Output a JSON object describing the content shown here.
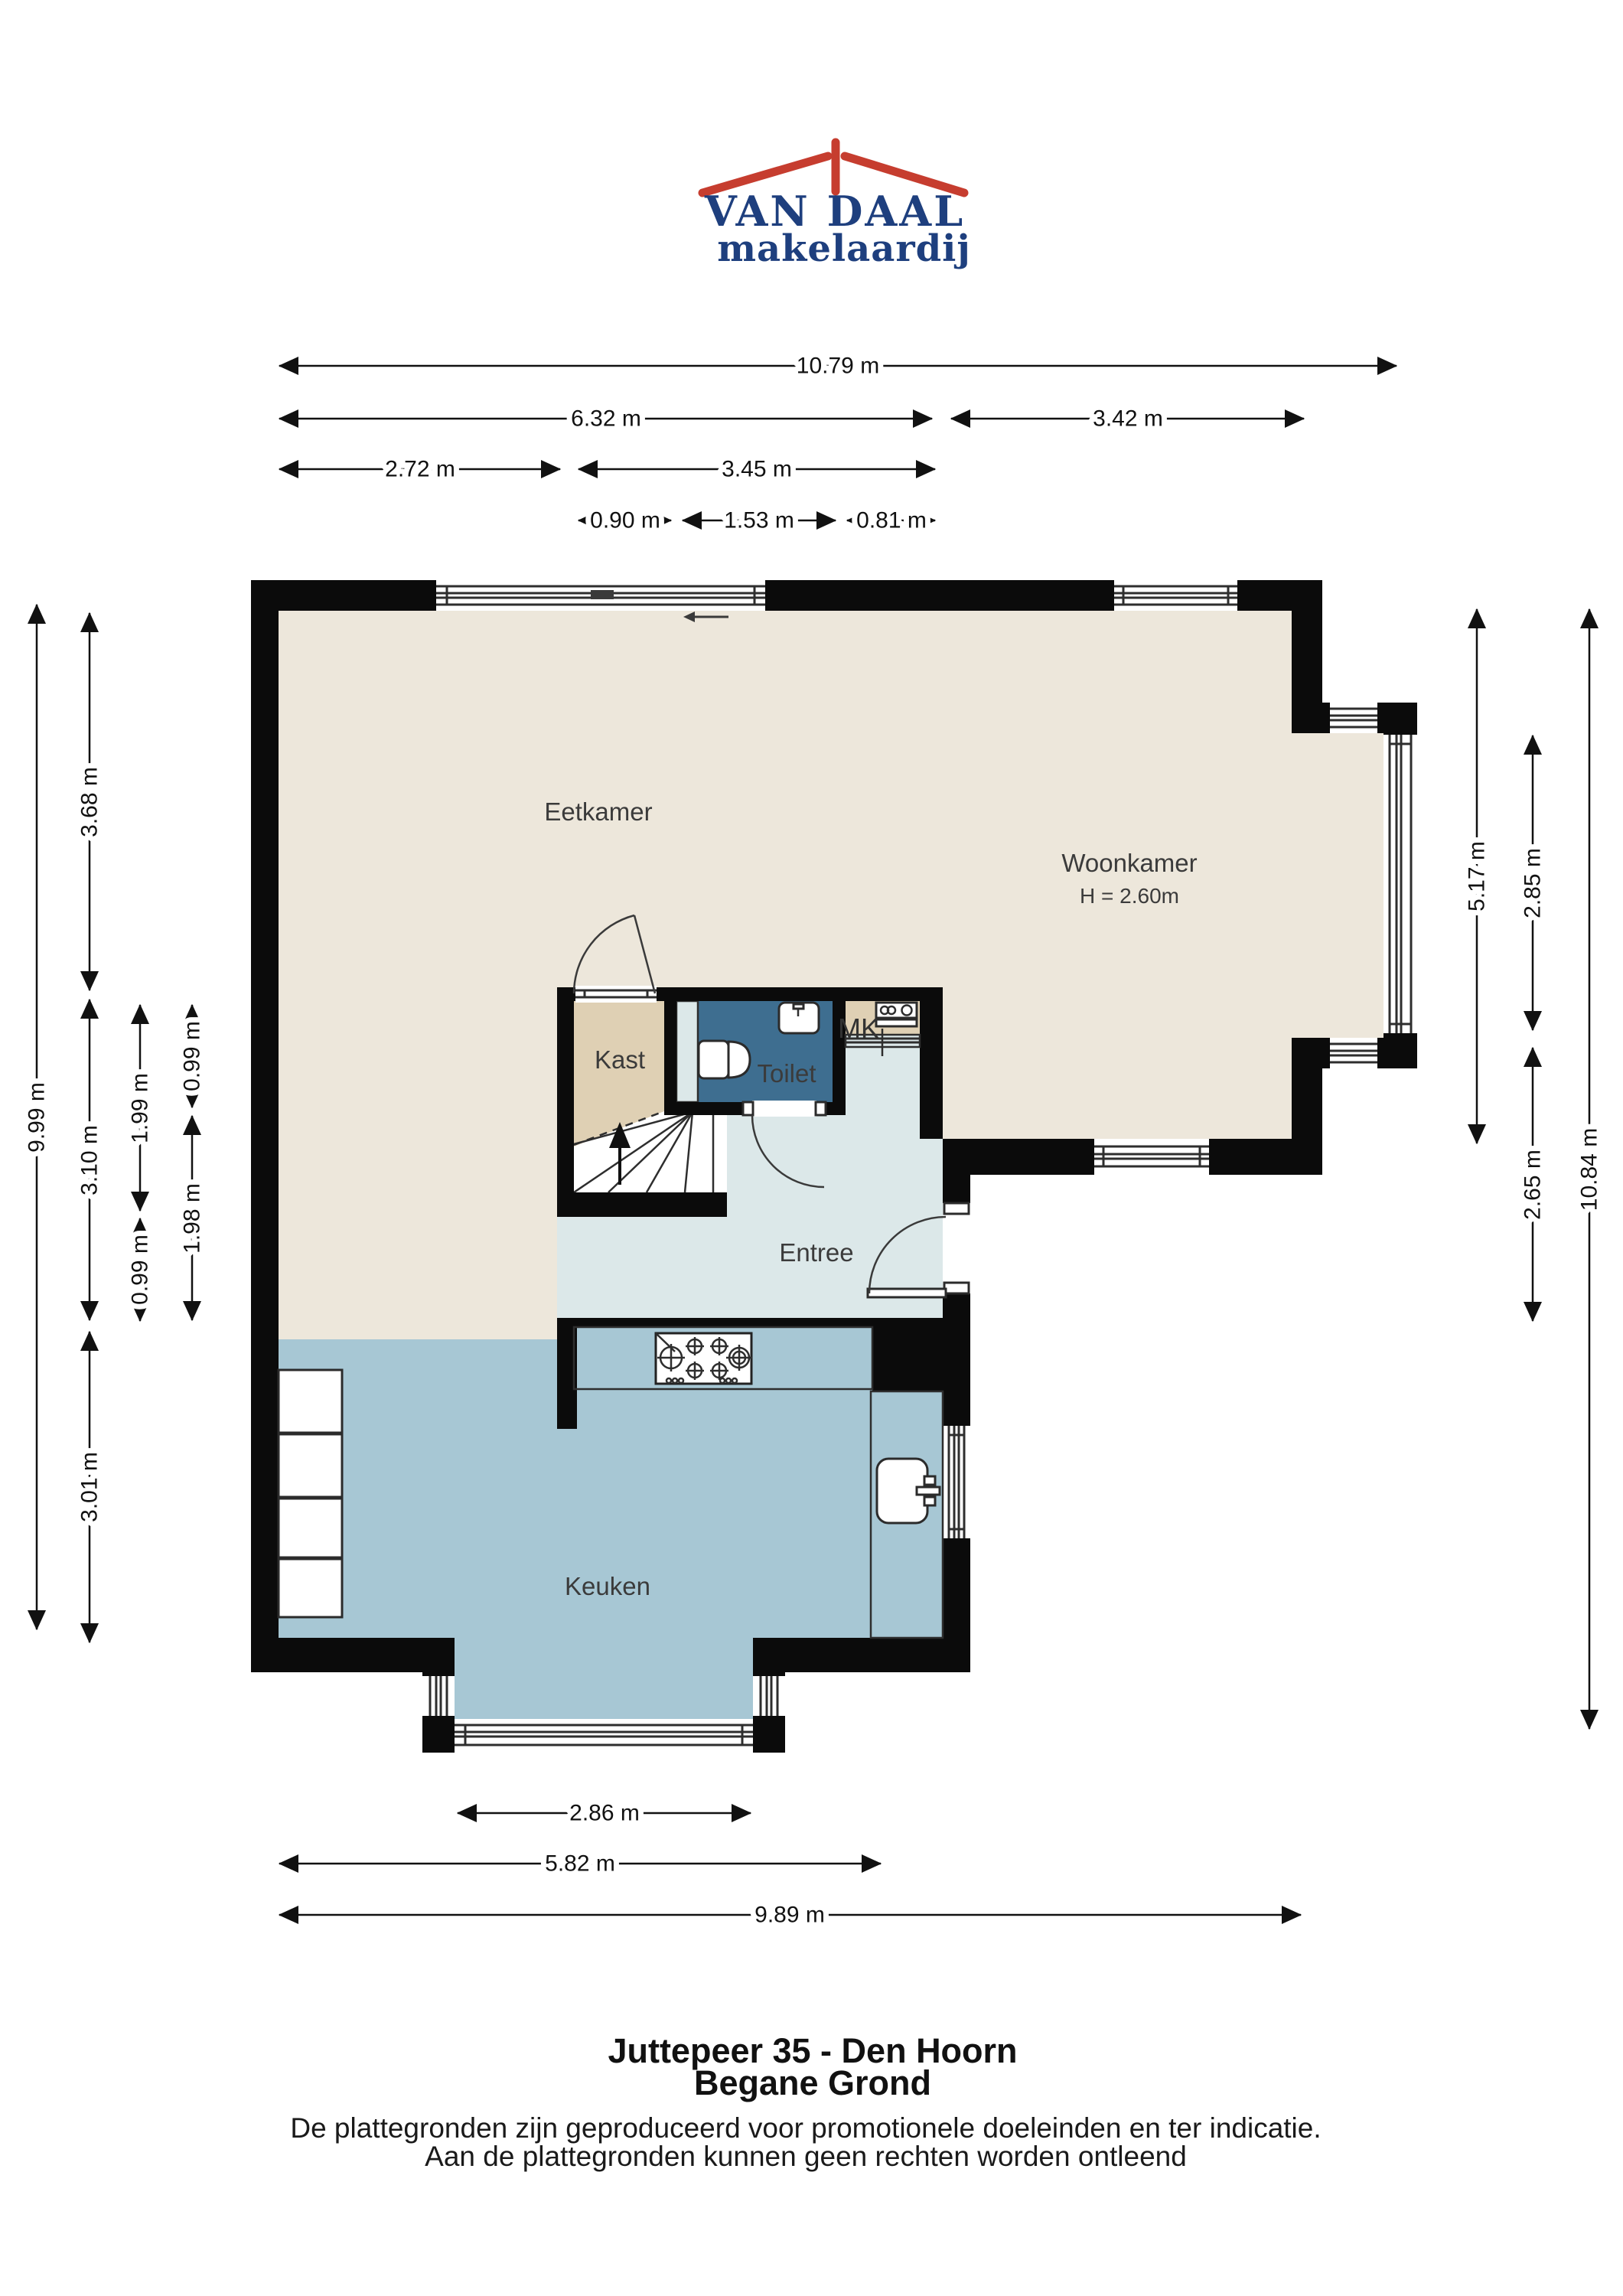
{
  "logo": {
    "name": "VAN DAAL",
    "tagline": "makelaardij",
    "brand_blue": "#1e3f7e",
    "brand_red": "#c63d2f"
  },
  "floorplan": {
    "rooms": [
      {
        "id": "eetkamer",
        "label": "Eetkamer"
      },
      {
        "id": "woonkamer",
        "label": "Woonkamer",
        "height_note": "H = 2.60m"
      },
      {
        "id": "kast",
        "label": "Kast"
      },
      {
        "id": "toilet",
        "label": "Toilet"
      },
      {
        "id": "mk",
        "label": "MK"
      },
      {
        "id": "entree",
        "label": "Entree"
      },
      {
        "id": "keuken",
        "label": "Keuken"
      }
    ],
    "colors": {
      "wall": "#0b0b0b",
      "living_floor": "#ede7db",
      "entree_floor": "#dce8e9",
      "keuken_floor": "#a7c7d4",
      "toilet_floor": "#3e6e90",
      "kast_floor": "#dfd0b4"
    },
    "dimensions_top": [
      {
        "label": "10.79 m"
      },
      {
        "label": "6.32 m"
      },
      {
        "label": "3.42 m"
      },
      {
        "label": "2.72 m"
      },
      {
        "label": "3.45 m"
      },
      {
        "label": "0.90 m"
      },
      {
        "label": "1.53 m"
      },
      {
        "label": "0.81 m"
      }
    ],
    "dimensions_left": [
      {
        "label": "9.99 m"
      },
      {
        "label": "3.68 m"
      },
      {
        "label": "3.10 m"
      },
      {
        "label": "3.01 m"
      },
      {
        "label": "1.99 m"
      },
      {
        "label": "0.99 m"
      },
      {
        "label": "0.99 m"
      },
      {
        "label": "1.98 m"
      }
    ],
    "dimensions_right": [
      {
        "label": "5.17 m"
      },
      {
        "label": "2.85 m"
      },
      {
        "label": "2.65 m"
      },
      {
        "label": "10.84 m"
      }
    ],
    "dimensions_bottom": [
      {
        "label": "2.86 m"
      },
      {
        "label": "5.82 m"
      },
      {
        "label": "9.89 m"
      }
    ]
  },
  "footer": {
    "title": "Juttepeer 35 - Den Hoorn",
    "subtitle": "Begane Grond",
    "disclaimer_line1": "De plattegronden zijn geproduceerd voor promotionele doeleinden en ter indicatie.",
    "disclaimer_line2": "Aan de plattegronden kunnen geen rechten worden ontleend"
  }
}
